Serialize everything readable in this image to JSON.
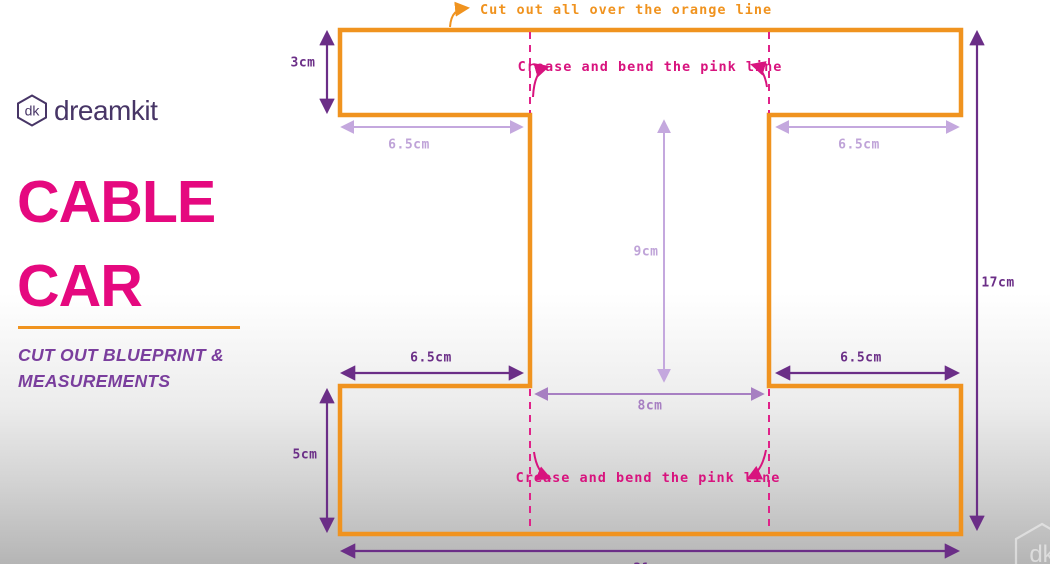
{
  "brand": {
    "logo_monogram": "dk",
    "logo_text": "dreamkit"
  },
  "panel": {
    "title_line1": "CABLE",
    "title_line2": "CAR",
    "subtitle_line1": "CUT OUT BLUEPRINT &",
    "subtitle_line2": "MEASUREMENTS"
  },
  "annotations": {
    "cut_note": "Cut out all over the orange line",
    "crease_note_top": "Crease and bend the pink line",
    "crease_note_bottom": "Crease and bend the pink line"
  },
  "measurements": {
    "top_flap_height": "3cm",
    "top_left_width": "6.5cm",
    "top_right_width": "6.5cm",
    "inner_height": "9cm",
    "inner_width": "8cm",
    "bottom_left_width": "6.5cm",
    "bottom_right_width": "6.5cm",
    "bottom_flap_height": "5cm",
    "total_height": "17cm",
    "total_width": "21cm"
  },
  "watermark": {
    "monogram": "dk"
  },
  "colors": {
    "cut_line_orange": "#F0931F",
    "crease_pink": "#D8137E",
    "fold_dash_pink": "#E02289",
    "title_magenta": "#E5097F",
    "measure_dark_purple": "#6B2E87",
    "measure_light_purple": "#C4A8DE",
    "measure_mid_purple": "#A77FC2",
    "brand_eggplant": "#473566",
    "subtitle_purple": "#7A3E9D"
  }
}
